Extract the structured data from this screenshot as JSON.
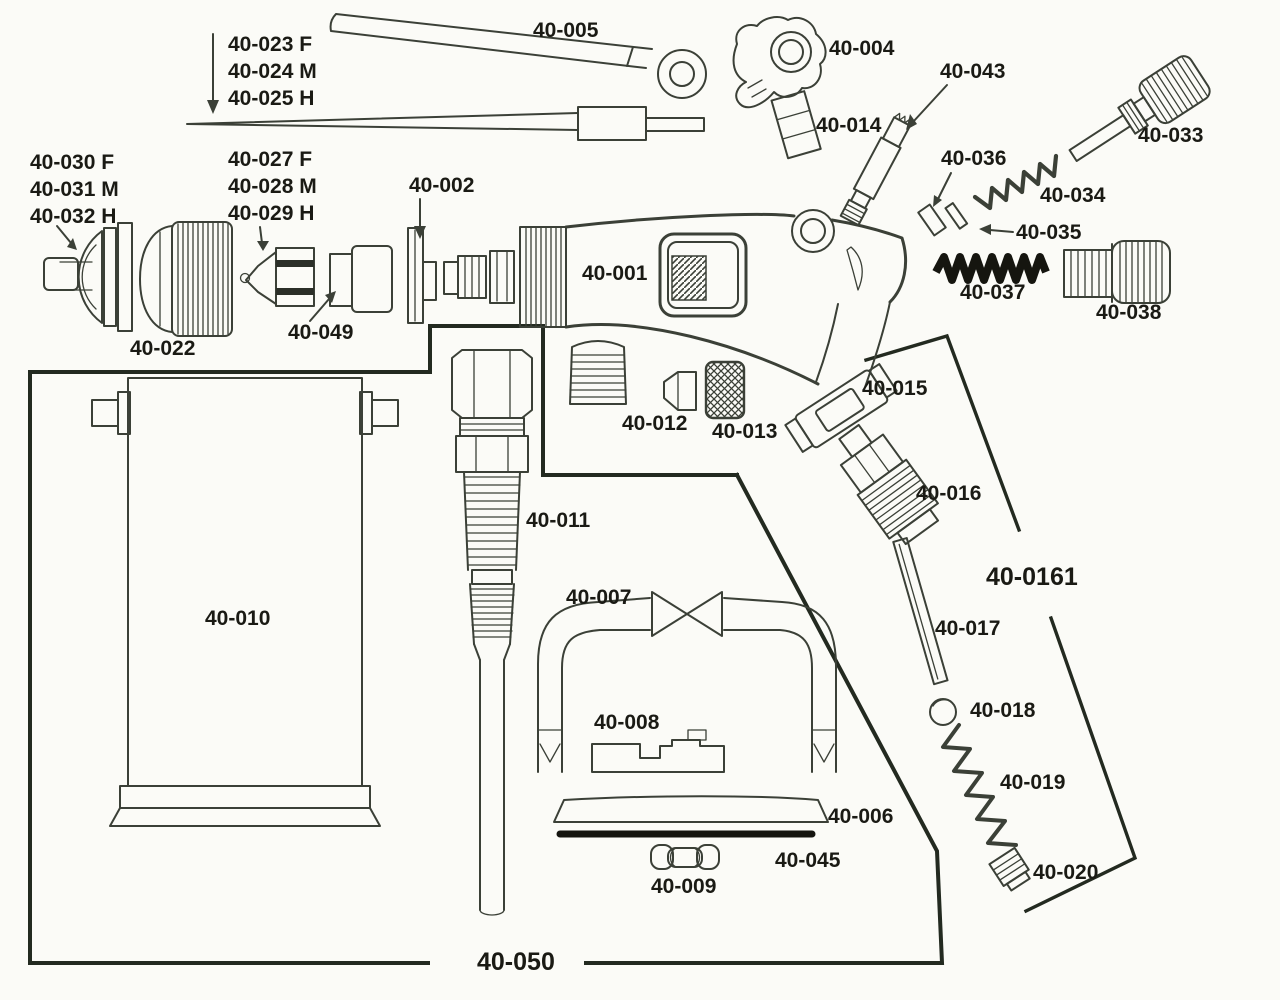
{
  "diagram": {
    "kind": "exploded-parts-diagram",
    "colors": {
      "line": "#3b4037",
      "heavy_outline": "#232a20",
      "black_part": "#15150f",
      "label_text": "#1a1a14",
      "background": "#fbfbf7"
    }
  },
  "labels": {
    "p005": "40-005",
    "p023": "40-023 F",
    "p024": "40-024 M",
    "p025": "40-025 H",
    "p004": "40-004",
    "p043": "40-043",
    "p014": "40-014",
    "p033": "40-033",
    "p036": "40-036",
    "p034": "40-034",
    "p035": "40-035",
    "p037": "40-037",
    "p038": "40-038",
    "p030": "40-030 F",
    "p031": "40-031 M",
    "p032": "40-032 H",
    "p027": "40-027 F",
    "p028": "40-028 M",
    "p029": "40-029 H",
    "p002": "40-002",
    "p022": "40-022",
    "p049": "40-049",
    "p001": "40-001",
    "p012": "40-012",
    "p013": "40-013",
    "p015": "40-015",
    "p016": "40-016",
    "p0161": "40-0161",
    "p017": "40-017",
    "p018": "40-018",
    "p019": "40-019",
    "p020": "40-020",
    "p011": "40-011",
    "p010": "40-010",
    "p007": "40-007",
    "p008": "40-008",
    "p006": "40-006",
    "p045": "40-045",
    "p009": "40-009",
    "p050": "40-050"
  }
}
